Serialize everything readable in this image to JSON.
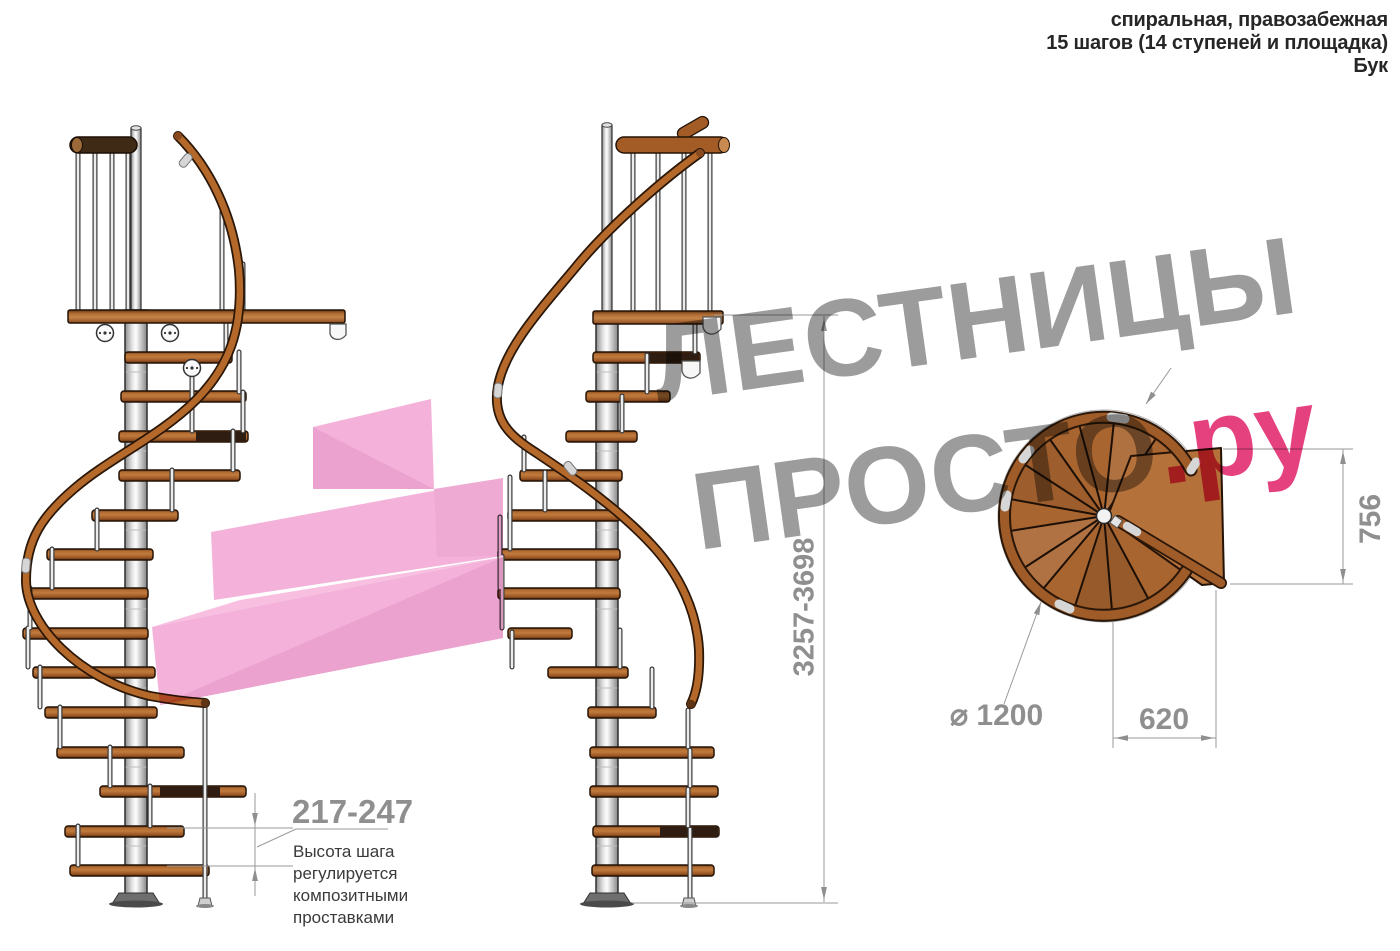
{
  "header": {
    "line1": "спиральная, правозабежная",
    "line2": "15 шагов (14 ступеней и площадка)",
    "line3": "Бук"
  },
  "watermark": {
    "line1": "ЛЕСТНИЦЫ",
    "line2_gray": "ПРОСТО",
    "line2_pink": ".ру"
  },
  "dimensions": {
    "total_height": "3257-3698",
    "step_height": "217-247",
    "diameter": "⌀ 1200",
    "platform_depth": "756",
    "platform_width": "620"
  },
  "annotation": {
    "line1": "Высота шага",
    "line2": "регулируется",
    "line3": "композитными",
    "line4": "проставками"
  },
  "colors": {
    "watermark_gray": "#9c9c9c",
    "watermark_pink": "#e5417f",
    "arrow_pink_light": "#f4b2da",
    "arrow_pink_dark": "#eca2cf",
    "wood": "#a05c28",
    "dimension_gray": "#8f8f8f"
  }
}
